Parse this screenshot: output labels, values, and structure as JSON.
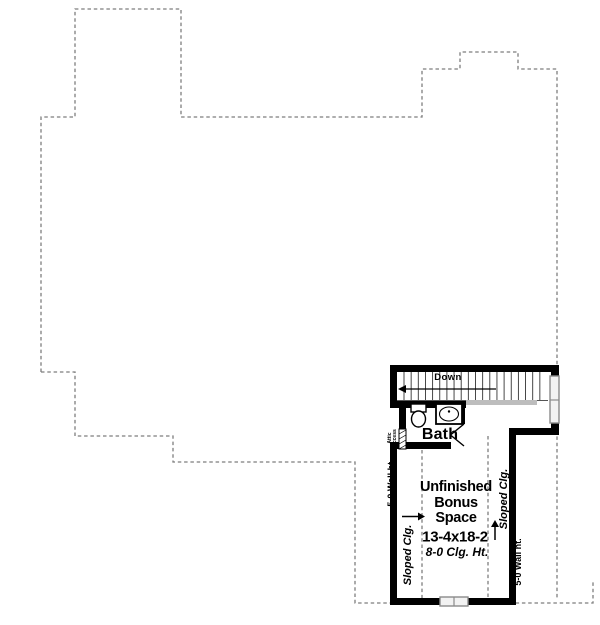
{
  "plan": {
    "stairs": {
      "direction_label": "Down"
    },
    "bath": {
      "label": "Bath",
      "attic_access_label": "Attic\nAccess"
    },
    "bonus_room": {
      "name": "Unfinished\nBonus\nSpace",
      "dimensions": "13-4x18-2",
      "ceiling_note": "8-0 Clg. Ht."
    },
    "annotations": {
      "left_wall_height": "5-0 Wall ht.",
      "right_wall_height": "5-0 Wall ht.",
      "left_sloped_ceiling": "Sloped Clg.",
      "right_sloped_ceiling": "Sloped Clg."
    },
    "colors": {
      "wall": "#000000",
      "outline_dashed": "#7e7e7e",
      "window_fill": "#f2f2f2",
      "background": "#ffffff"
    }
  }
}
